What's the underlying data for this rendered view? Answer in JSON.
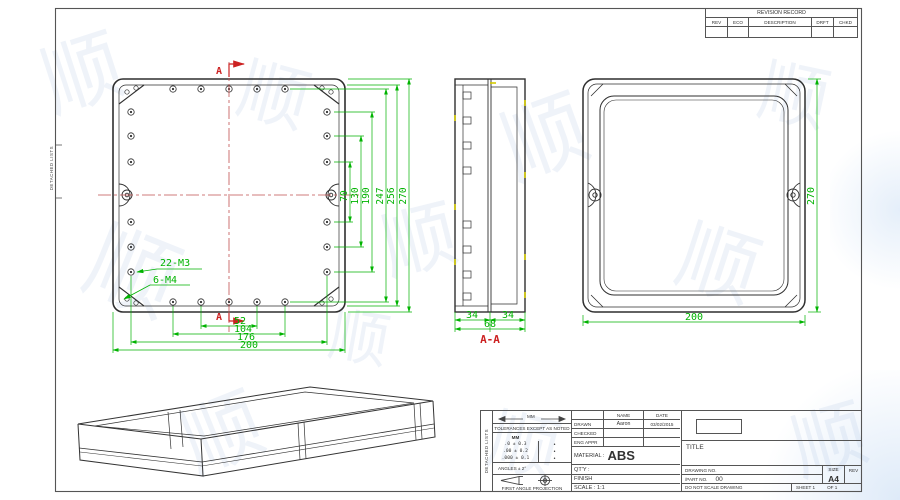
{
  "frame": {
    "strip_label": "DETACHED LISTS"
  },
  "revision_table": {
    "title": "REVISION RECORD",
    "columns": [
      "REV",
      "ECO",
      "DESCRIPTION",
      "DRFT",
      "CHKD"
    ]
  },
  "title_block": {
    "units_label": "MM",
    "tolerance_heading": "TOLERANCES EXCEPT AS NOTED",
    "tolerance_unit_header": "MM",
    "tolerance_rows": [
      ".0 ± 0.3",
      ".00 ± 0.2",
      ".000 ± 0.1"
    ],
    "tolerance_marks": [
      "•",
      "•",
      "•"
    ],
    "angles": "ANGLES ± 2°",
    "projection_label": "FIRST ANGLE PROJECTION",
    "name_header": "NAME",
    "date_header": "DATE",
    "drawn_label": "DRAWN",
    "drawn_name": "Aaron",
    "drawn_date": "03/02/2015",
    "checked_label": "CHECKED",
    "eng_appr_label": "ENG APPR",
    "material_label": "MATERIAL :",
    "material_value": "ABS",
    "qty_label": "QT'Y :",
    "finish_label": "FINISH",
    "scale_label": "SCALE : 1:1",
    "title_label": "TITLE",
    "drawing_no_label": "DRAWING NO.",
    "part_no_label": "/PART  NO.",
    "part_no_value": "00",
    "size_label": "SIZE",
    "size_value": "A4",
    "rev_label": "REV",
    "do_not_scale": "DO NOT SCALE DRAWING",
    "sheet_label": "SHEET 1",
    "of_label": "OF 1"
  },
  "views": {
    "front": {
      "section_marker": "A",
      "thread_note_m3": "22-M3",
      "thread_note_m4": "6-M4",
      "dims_bottom": [
        "52",
        "104",
        "176",
        "200"
      ],
      "dims_right": [
        "70",
        "130",
        "190",
        "247",
        "256",
        "270"
      ]
    },
    "section": {
      "label": "A-A",
      "dim_left": "34",
      "dim_right": "34",
      "dim_total": "68"
    },
    "back": {
      "dim_height": "270",
      "dim_width": "200"
    }
  },
  "watermark": {
    "glyph": "顺"
  },
  "colors": {
    "dimension": "#00b300",
    "section_mark": "#cc2222",
    "centerline": "#c05050",
    "line": "#2f2f2f"
  }
}
